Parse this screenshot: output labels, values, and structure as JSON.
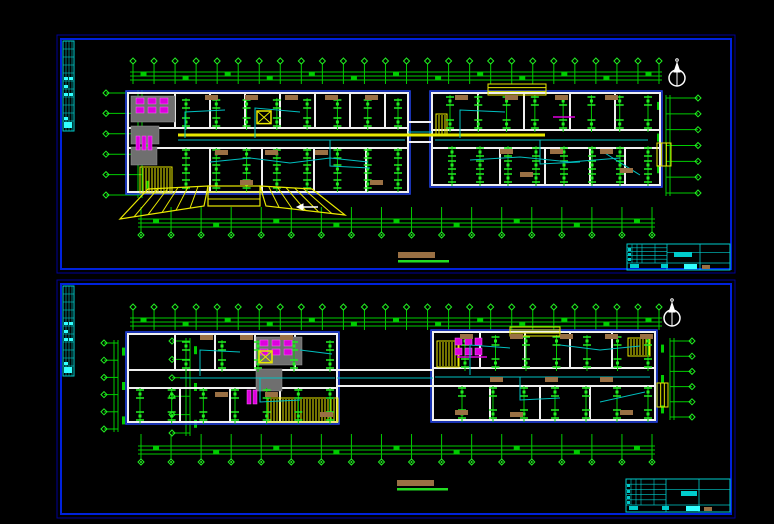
{
  "palette": {
    "bg": "#000000",
    "frame_outer": "#000099",
    "frame_inner": "#0022dd",
    "plan_blue": "#2244ee",
    "wall": "#f0f0f0",
    "green": "#00cc00",
    "green_bright": "#22ee22",
    "cyan": "#00cccc",
    "cyan_bright": "#33ffff",
    "wire": "#00c0c0",
    "yellow": "#e8e800",
    "magenta": "#dd00dd",
    "gray": "#6f6f6f",
    "tan": "#9a7044",
    "white": "#ffffff"
  },
  "canvas": {
    "w": 774,
    "h": 524
  },
  "sheets": [
    {
      "name": "sheet-upper-floor-plan",
      "frame": {
        "x": 57,
        "y": 35,
        "w": 678,
        "h": 238
      },
      "strip": {
        "x": 63,
        "y": 41,
        "w": 11,
        "h": 90,
        "blobs": [
          [
            1,
            36,
            4,
            3
          ],
          [
            6,
            36,
            4,
            3
          ],
          [
            1,
            44,
            4,
            3
          ],
          [
            1,
            52,
            4,
            3
          ],
          [
            6,
            52,
            4,
            3
          ],
          [
            1,
            76,
            4,
            3
          ],
          [
            1,
            81,
            8,
            6
          ]
        ]
      },
      "north": {
        "cx": 677,
        "cy": 78
      },
      "chainsH": [
        {
          "x0": 130,
          "x1": 662,
          "y": 72,
          "n": 26,
          "marker": "top"
        },
        {
          "x0": 138,
          "x1": 655,
          "y": 219,
          "n": 18,
          "marker": "bottom"
        }
      ],
      "chainsV": [
        {
          "x": 138,
          "y0": 90,
          "y1": 198,
          "n": 6,
          "mx": 106
        },
        {
          "x": 666,
          "y0": 95,
          "y1": 196,
          "n": 7,
          "mx": 698
        }
      ],
      "blocks": [
        {
          "x": 128,
          "y": 93,
          "w": 280,
          "h": 99,
          "corridor": [
            128,
            148
          ],
          "topParts": [
            175,
            210,
            245,
            280,
            315,
            350,
            385
          ],
          "botParts": [
            210,
            262,
            314,
            366
          ]
        },
        {
          "x": 432,
          "y": 93,
          "w": 228,
          "h": 92,
          "corridor": [
            130,
            148
          ],
          "topParts": [
            478,
            524,
            570,
            615
          ],
          "botParts": [
            500,
            545,
            590,
            625
          ]
        }
      ],
      "bridge": {
        "x0": 408,
        "x1": 432,
        "ys": [
          122,
          142
        ]
      },
      "grays": [
        [
          131,
          96,
          44,
          26
        ],
        [
          131,
          126,
          28,
          18
        ],
        [
          131,
          147,
          26,
          18
        ]
      ],
      "magentas": [
        {
          "x": 136,
          "y": 98,
          "cols": 3,
          "rows": 2,
          "cw": 12,
          "ch": 9,
          "bw": 8,
          "bh": 6
        },
        {
          "x": 136,
          "y": 136,
          "cols": 3,
          "rows": 1,
          "cw": 6,
          "ch": 16,
          "bw": 4,
          "bh": 14
        }
      ],
      "combs": [
        [
          140,
          167,
          32,
          26
        ],
        [
          436,
          114,
          11,
          22
        ]
      ],
      "xboxes": [
        [
          257,
          111,
          14
        ]
      ],
      "trays": [
        [
          [
            178,
            135
          ],
          [
            545,
            135
          ]
        ]
      ],
      "magentaLines": [
        [
          [
            553,
            117
          ],
          [
            575,
            117
          ]
        ]
      ],
      "ytopboxes": [
        [
          488,
          84,
          58,
          11
        ]
      ],
      "doorbars": [
        [
          657,
          143,
          14,
          23
        ]
      ],
      "canopy": {
        "center": [
          208,
          186,
          52,
          20
        ],
        "left": [
          [
            148,
            189
          ],
          [
            208,
            186
          ],
          [
            204,
            206
          ],
          [
            120,
            219
          ]
        ],
        "right": [
          [
            260,
            186
          ],
          [
            312,
            189
          ],
          [
            345,
            215
          ],
          [
            266,
            206
          ]
        ]
      },
      "arrows": [
        [
          [
            318,
            207
          ],
          [
            303,
            207
          ]
        ]
      ],
      "grids": [
        {
          "x0": 186,
          "x1": 398,
          "y0": 104,
          "y1": 122,
          "cols": 8,
          "rows": 2
        },
        {
          "x0": 186,
          "x1": 398,
          "y0": 154,
          "y1": 184,
          "cols": 8,
          "rows": 3
        },
        {
          "x0": 450,
          "x1": 648,
          "y0": 101,
          "y1": 124,
          "cols": 8,
          "rows": 2
        },
        {
          "x0": 452,
          "x1": 648,
          "y0": 152,
          "y1": 178,
          "cols": 8,
          "rows": 3
        }
      ],
      "browns": [
        [
          205,
          95
        ],
        [
          245,
          95
        ],
        [
          285,
          95
        ],
        [
          325,
          95
        ],
        [
          365,
          95
        ],
        [
          455,
          95
        ],
        [
          505,
          95
        ],
        [
          555,
          95
        ],
        [
          605,
          95
        ],
        [
          215,
          150
        ],
        [
          265,
          150
        ],
        [
          315,
          150
        ],
        [
          500,
          149
        ],
        [
          550,
          149
        ],
        [
          600,
          149
        ],
        [
          240,
          180
        ],
        [
          370,
          180
        ],
        [
          520,
          172
        ],
        [
          620,
          168
        ]
      ],
      "wires": [
        [
          [
            178,
            140
          ],
          [
            405,
            140
          ]
        ],
        [
          [
            435,
            140
          ],
          [
            648,
            140
          ]
        ],
        [
          [
            185,
            138
          ],
          [
            185,
            112
          ],
          [
            225,
            110
          ]
        ],
        [
          [
            255,
            138
          ],
          [
            255,
            108
          ],
          [
            300,
            112
          ]
        ],
        [
          [
            330,
            140
          ],
          [
            330,
            166
          ],
          [
            370,
            168
          ]
        ],
        [
          [
            210,
            162
          ],
          [
            250,
            158
          ],
          [
            290,
            163
          ],
          [
            330,
            158
          ],
          [
            368,
            162
          ]
        ],
        [
          [
            460,
            138
          ],
          [
            460,
            110
          ],
          [
            505,
            112
          ]
        ],
        [
          [
            540,
            140
          ],
          [
            540,
            164
          ],
          [
            580,
            162
          ]
        ],
        [
          [
            470,
            160
          ],
          [
            520,
            157
          ],
          [
            570,
            162
          ],
          [
            620,
            158
          ]
        ],
        [
          [
            600,
            150
          ],
          [
            640,
            175
          ]
        ]
      ],
      "caption": {
        "x": 398,
        "y": 252
      },
      "titleblock": {
        "x": 627,
        "y": 244,
        "w": 103,
        "h": 26,
        "blobs": [
          [
            47,
            8,
            18,
            5,
            "c"
          ],
          [
            3,
            20,
            9,
            4,
            "c"
          ],
          [
            34,
            20,
            7,
            4,
            "c"
          ],
          [
            57,
            20,
            13,
            5,
            "b"
          ],
          [
            75,
            21,
            8,
            4,
            "t"
          ],
          [
            1,
            4,
            3,
            3,
            "c"
          ],
          [
            1,
            9,
            3,
            3,
            "c"
          ],
          [
            1,
            14,
            3,
            3,
            "c"
          ]
        ]
      }
    },
    {
      "name": "sheet-lower-floor-plan",
      "frame": {
        "x": 57,
        "y": 280,
        "w": 678,
        "h": 238
      },
      "strip": {
        "x": 63,
        "y": 286,
        "w": 11,
        "h": 90,
        "blobs": [
          [
            1,
            36,
            4,
            3
          ],
          [
            6,
            36,
            4,
            3
          ],
          [
            1,
            44,
            4,
            3
          ],
          [
            1,
            52,
            4,
            3
          ],
          [
            6,
            52,
            4,
            3
          ],
          [
            1,
            76,
            4,
            3
          ],
          [
            1,
            81,
            8,
            6
          ]
        ]
      },
      "north": {
        "cx": 672,
        "cy": 318
      },
      "chainsH": [
        {
          "x0": 130,
          "x1": 662,
          "y": 318,
          "n": 26,
          "marker": "top"
        },
        {
          "x0": 138,
          "x1": 655,
          "y": 446,
          "n": 18,
          "marker": "bottom"
        }
      ],
      "chainsV": [
        {
          "x": 114,
          "y0": 340,
          "y1": 432,
          "n": 6,
          "mx": 104
        },
        {
          "x": 186,
          "y0": 338,
          "y1": 436,
          "n": 6,
          "mx": 172
        },
        {
          "x": 670,
          "y0": 338,
          "y1": 420,
          "n": 6,
          "mx": 692
        }
      ],
      "blocks": [
        {
          "x": 128,
          "y": 334,
          "w": 209,
          "h": 88,
          "corridor": [
            370,
            388
          ],
          "topParts": [
            175,
            215,
            255,
            295
          ],
          "botParts": [
            180,
            230,
            280
          ]
        },
        {
          "x": 433,
          "y": 332,
          "w": 222,
          "h": 88,
          "corridor": [
            368,
            386
          ],
          "topParts": [
            480,
            525,
            570,
            612
          ],
          "botParts": [
            490,
            540,
            590
          ]
        }
      ],
      "bridge": {
        "x0": 337,
        "x1": 433,
        "ys": [
          370,
          386
        ]
      },
      "grays": [
        [
          256,
          337,
          46,
          28
        ],
        [
          256,
          369,
          26,
          22
        ]
      ],
      "magentas": [
        {
          "x": 260,
          "y": 340,
          "cols": 3,
          "rows": 2,
          "cw": 12,
          "ch": 9,
          "bw": 8,
          "bh": 6
        },
        {
          "x": 247,
          "y": 390,
          "cols": 2,
          "rows": 1,
          "cw": 6,
          "ch": 16,
          "bw": 4,
          "bh": 14
        },
        {
          "x": 455,
          "y": 338,
          "cols": 3,
          "rows": 2,
          "cw": 10,
          "ch": 10,
          "bw": 7,
          "bh": 7
        }
      ],
      "combs": [
        [
          268,
          398,
          70,
          24
        ],
        [
          437,
          341,
          22,
          26
        ],
        [
          628,
          338,
          22,
          18
        ]
      ],
      "xboxes": [
        [
          259,
          351,
          13
        ]
      ],
      "trays": [],
      "magentaLines": [
        [
          [
            457,
            357
          ],
          [
            487,
            357
          ]
        ]
      ],
      "ytopboxes": [
        [
          510,
          327,
          50,
          9
        ]
      ],
      "doorbars": [
        [
          657,
          383,
          11,
          24
        ]
      ],
      "canopy": null,
      "arrows": [],
      "grids": [
        {
          "x0": 186,
          "x1": 330,
          "y0": 346,
          "y1": 364,
          "cols": 5,
          "rows": 2
        },
        {
          "x0": 140,
          "x1": 330,
          "y0": 394,
          "y1": 416,
          "cols": 7,
          "rows": 2
        },
        {
          "x0": 465,
          "x1": 648,
          "y0": 341,
          "y1": 363,
          "cols": 7,
          "rows": 2
        },
        {
          "x0": 462,
          "x1": 648,
          "y0": 392,
          "y1": 414,
          "cols": 7,
          "rows": 2
        }
      ],
      "browns": [
        [
          200,
          335
        ],
        [
          240,
          335
        ],
        [
          280,
          335
        ],
        [
          460,
          334
        ],
        [
          510,
          334
        ],
        [
          560,
          334
        ],
        [
          605,
          334
        ],
        [
          640,
          334
        ],
        [
          215,
          392
        ],
        [
          265,
          392
        ],
        [
          490,
          377
        ],
        [
          545,
          377
        ],
        [
          600,
          377
        ],
        [
          320,
          412
        ],
        [
          620,
          410
        ],
        [
          455,
          410
        ],
        [
          510,
          412
        ]
      ],
      "wires": [
        [
          [
            180,
            378
          ],
          [
            335,
            378
          ]
        ],
        [
          [
            435,
            377
          ],
          [
            650,
            377
          ]
        ],
        [
          [
            200,
            376
          ],
          [
            200,
            350
          ],
          [
            240,
            352
          ]
        ],
        [
          [
            260,
            378
          ],
          [
            260,
            402
          ],
          [
            300,
            400
          ]
        ],
        [
          [
            300,
            350
          ],
          [
            332,
            354
          ]
        ],
        [
          [
            470,
            375
          ],
          [
            470,
            345
          ],
          [
            510,
            348
          ]
        ],
        [
          [
            520,
            377
          ],
          [
            520,
            400
          ],
          [
            560,
            398
          ]
        ],
        [
          [
            560,
            345
          ],
          [
            600,
            350
          ],
          [
            640,
            346
          ]
        ],
        [
          [
            600,
            402
          ],
          [
            645,
            392
          ]
        ]
      ],
      "caption": {
        "x": 397,
        "y": 480
      },
      "titleblock": {
        "x": 626,
        "y": 479,
        "w": 104,
        "h": 33,
        "blobs": [
          [
            55,
            12,
            16,
            5,
            "c"
          ],
          [
            3,
            27,
            9,
            4,
            "c"
          ],
          [
            36,
            27,
            7,
            4,
            "c"
          ],
          [
            60,
            27,
            14,
            5,
            "b"
          ],
          [
            78,
            28,
            8,
            4,
            "t"
          ],
          [
            1,
            5,
            3,
            3,
            "c"
          ],
          [
            1,
            11,
            3,
            3,
            "c"
          ],
          [
            1,
            17,
            3,
            3,
            "c"
          ],
          [
            1,
            22,
            3,
            3,
            "c"
          ]
        ]
      }
    }
  ]
}
